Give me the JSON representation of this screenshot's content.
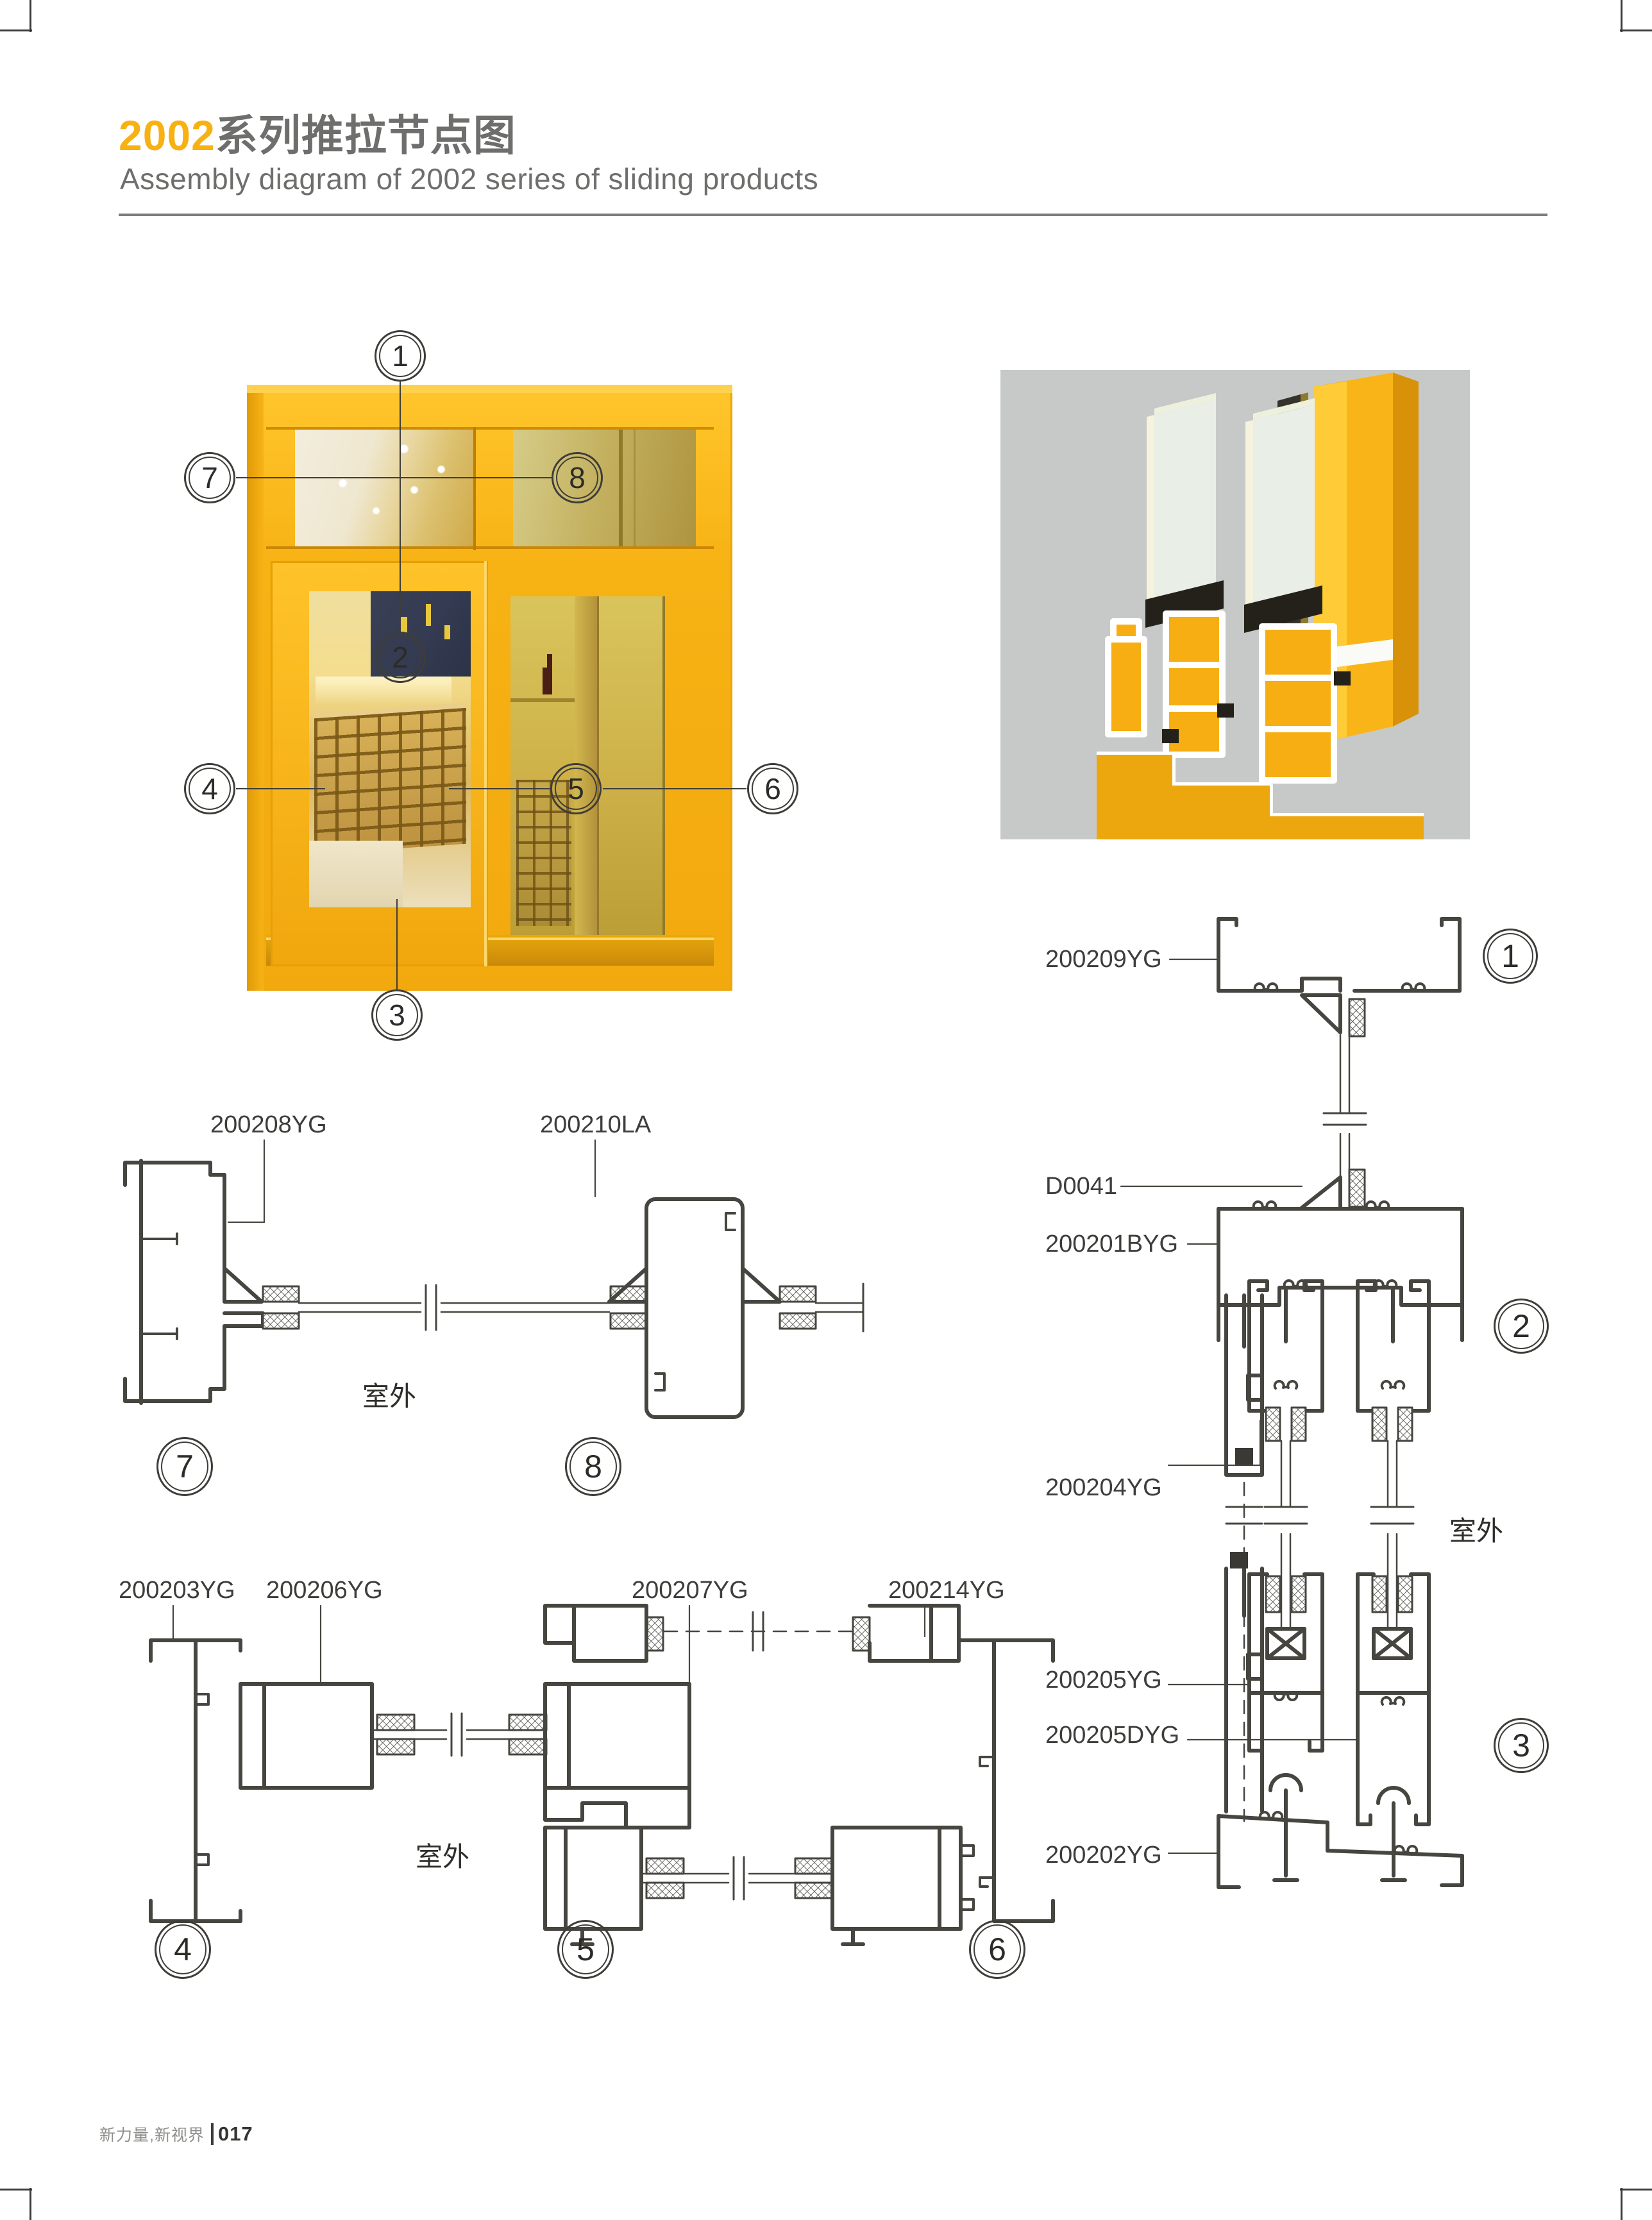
{
  "colors": {
    "accent_orange": "#f8b112",
    "title_gray": "#6e6e6c",
    "drawing_line": "#46453f",
    "frame_yellow": "#f6b316",
    "render_panel_gray": "#c7c9c8"
  },
  "header": {
    "series": "2002",
    "title_cn": "系列推拉节点图",
    "subtitle": "Assembly diagram of 2002 series of sliding products"
  },
  "callouts": {
    "n1": "1",
    "n2": "2",
    "n3": "3",
    "n4": "4",
    "n5": "5",
    "n6": "6",
    "n7": "7",
    "n8": "8"
  },
  "labels": {
    "outdoor": "室外"
  },
  "sections": {
    "s78": {
      "left": "200208YG",
      "right": "200210LA"
    },
    "s456": {
      "l1": "200203YG",
      "l2": "200206YG",
      "l3": "200207YG",
      "l4": "200214YG"
    },
    "s123": {
      "l1": "200209YG",
      "l2": "D0041",
      "l3": "200201BYG",
      "l4": "200204YG",
      "l5": "200205YG",
      "l6": "200205DYG",
      "l7": "200202YG"
    }
  },
  "footer": {
    "brand": "新力量,新视界",
    "page": "017"
  }
}
